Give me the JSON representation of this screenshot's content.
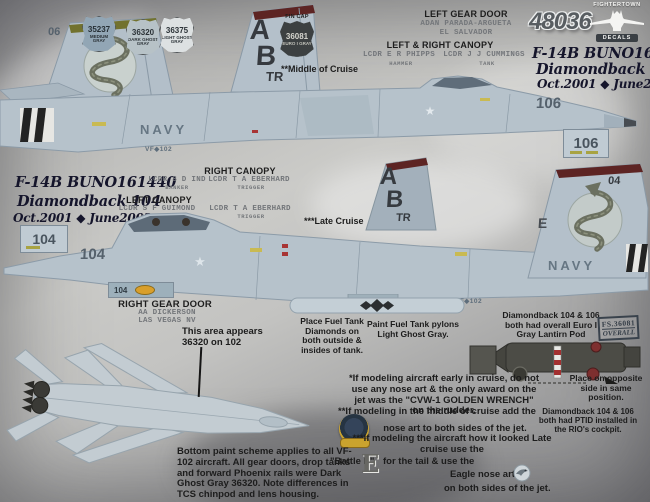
{
  "sheet": {
    "catalog_number": "48036",
    "brand_line1": "FIGHTERTOWN",
    "brand_line2": "DECALS"
  },
  "colors": {
    "chip_35237": "#92a6b5",
    "chip_36320": "#b7c2c7",
    "chip_36375": "#dde1e2",
    "chip_36081": "#3c4041",
    "jet_gray": "#b6c2cb",
    "fin_cap_olive": "#72722e",
    "fin_cap_maroon": "#5d2423"
  },
  "paint_chips": [
    {
      "fs": "35237",
      "name": "MEDIUM GRAY"
    },
    {
      "fs": "36320",
      "name": "DARK GHOST GRAY"
    },
    {
      "fs": "36375",
      "name": "LIGHT GHOST GRAY"
    }
  ],
  "fin_cap_chip": {
    "label": "FIN CAP",
    "fs": "36081",
    "name": "EURO I GRAY"
  },
  "left_gear_door": {
    "heading": "LEFT GEAR DOOR",
    "name": "ADAN  PARADA-ARGUETA",
    "hometown": "EL  SALVADOR"
  },
  "right_gear_door": {
    "heading": "RIGHT GEAR DOOR",
    "name": "AA  DICKERSON",
    "hometown": "LAS  VEGAS  NV"
  },
  "jet106": {
    "title": "F-14B BUNO162910",
    "name": "Diamondback 106",
    "dates": "Oct.2001 ◆ June2002",
    "cruise_note": "**Middle of Cruise",
    "modex": "106",
    "modex_box": "106",
    "left_tail_modex": "06",
    "tail_letter_a": "A",
    "tail_letter_b": "B",
    "tail_code": "TR",
    "navy": "NAVY",
    "squadron": "VF◆102",
    "canopy": {
      "heading": "LEFT & RIGHT CANOPY",
      "front_name": "LCDR  E  R  PHIPPS",
      "front_callsign": "HAMMER",
      "rear_name": "LCDR  J  J  CUMMINGS",
      "rear_callsign": "TANK"
    }
  },
  "jet104": {
    "title": "F-14B BUNO161440",
    "name": "Diamondback 104",
    "dates": "Oct.2001 ◆ June2002",
    "cruise_note": "***Late Cruise",
    "modex": "104",
    "modex_box": "104",
    "gear_door_modex": "104",
    "tail_modex": "04",
    "tail_e": "E",
    "tail_letter_a": "A",
    "tail_letter_b": "B",
    "tail_code": "TR",
    "navy": "NAVY",
    "squadron": "VF◆102",
    "right_canopy": {
      "heading": "RIGHT CANOPY",
      "front_name": "LCDR  S  D  IND",
      "front_callsign": "BANKER",
      "rear_name": "LCDR  T  A  EBERHARD",
      "rear_callsign": "TRIGGER"
    },
    "left_canopy": {
      "heading": "LEFT CANOPY",
      "front_name": "LCDR  S  F  GUIMOND",
      "front_callsign": "GUIDO",
      "rear_name": "LCDR  T  A  EBERHARD",
      "rear_callsign": "TRIGGER"
    }
  },
  "notes": {
    "area_36320": "This area appears\n36320 on 102",
    "fuel_diamonds": "Place Fuel Tank Diamonds on both outside & insides of tank.",
    "fuel_pylons": "Paint Fuel Tank pylons Light Ghost Gray.",
    "lantirn": "Diamondback 104 & 106 both had overall Euro I Gray Lantirn Pod",
    "stamp_fs": "FS.36081",
    "stamp_overall": "OVERALL",
    "place_opposite": "Place on opposite side in same position.",
    "early": "*If modeling aircraft early in cruise, do not use any nose art & the only award on the jet was the \"CVW-1 GOLDEN WRENCH\" on the rudder.",
    "middle_a": "**If modeling in the middle of cruise add the",
    "middle_b": "nose art to both sides of the jet.",
    "ptid": "Diamondback 104 & 106 both had PTID installed in the RIO's cockpit.",
    "late_a": "***If modeling the aircraft how it looked Late cruise  use the",
    "late_b": "\"Battle E\"",
    "battle_e_glyph": "E",
    "late_c": "for the tail & use the",
    "late_d": "Eagle nose art",
    "late_e": "on both sides of the jet.",
    "bottom_scheme": "Bottom paint scheme applies to all VF-102 aircraft. All gear doors, drop tanks and forward Phoenix rails were Dark Ghost Gray 36320. Note differences in TCS chinpod and lens housing."
  }
}
